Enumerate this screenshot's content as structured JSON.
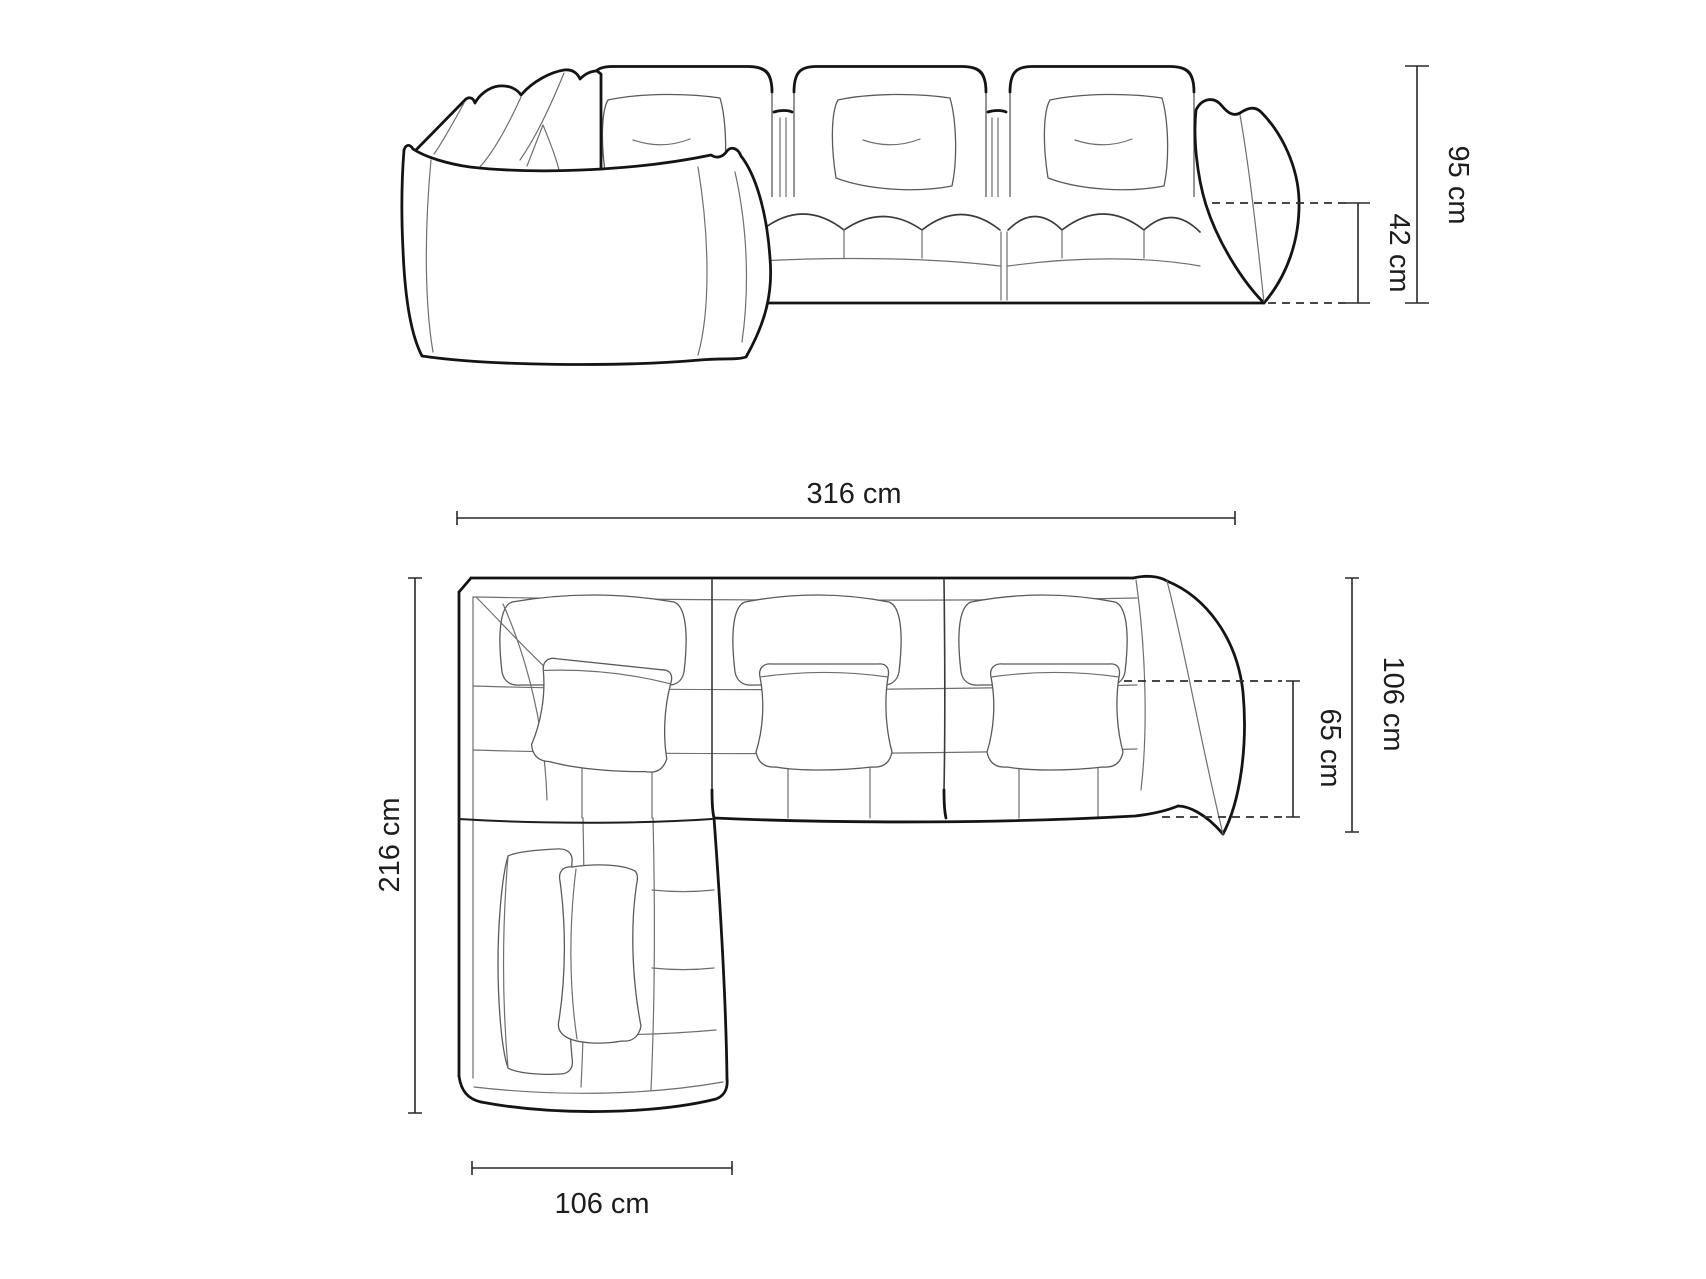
{
  "diagram": {
    "subject": "Modular corner sofa technical dimension drawing",
    "style": "black line art on white background",
    "line_color": "#141414",
    "label_color": "#1d1d1d",
    "views": [
      {
        "id": "front-elevation",
        "dimensions": [
          {
            "label": "95 cm",
            "value": 95,
            "unit": "cm",
            "measures": "overall height",
            "orientation": "vertical-right"
          },
          {
            "label": "42 cm",
            "value": 42,
            "unit": "cm",
            "measures": "seat height",
            "orientation": "vertical-right"
          }
        ]
      },
      {
        "id": "top-plan",
        "dimensions": [
          {
            "label": "316 cm",
            "value": 316,
            "unit": "cm",
            "measures": "overall width",
            "orientation": "horizontal-top"
          },
          {
            "label": "216 cm",
            "value": 216,
            "unit": "cm",
            "measures": "overall depth chaise side",
            "orientation": "vertical-left"
          },
          {
            "label": "106 cm",
            "value": 106,
            "unit": "cm",
            "measures": "body depth",
            "orientation": "vertical-right"
          },
          {
            "label": "65 cm",
            "value": 65,
            "unit": "cm",
            "measures": "seat depth",
            "orientation": "vertical-right"
          },
          {
            "label": "106 cm",
            "value": 106,
            "unit": "cm",
            "measures": "chaise width",
            "orientation": "horizontal-bottom"
          }
        ]
      }
    ]
  }
}
